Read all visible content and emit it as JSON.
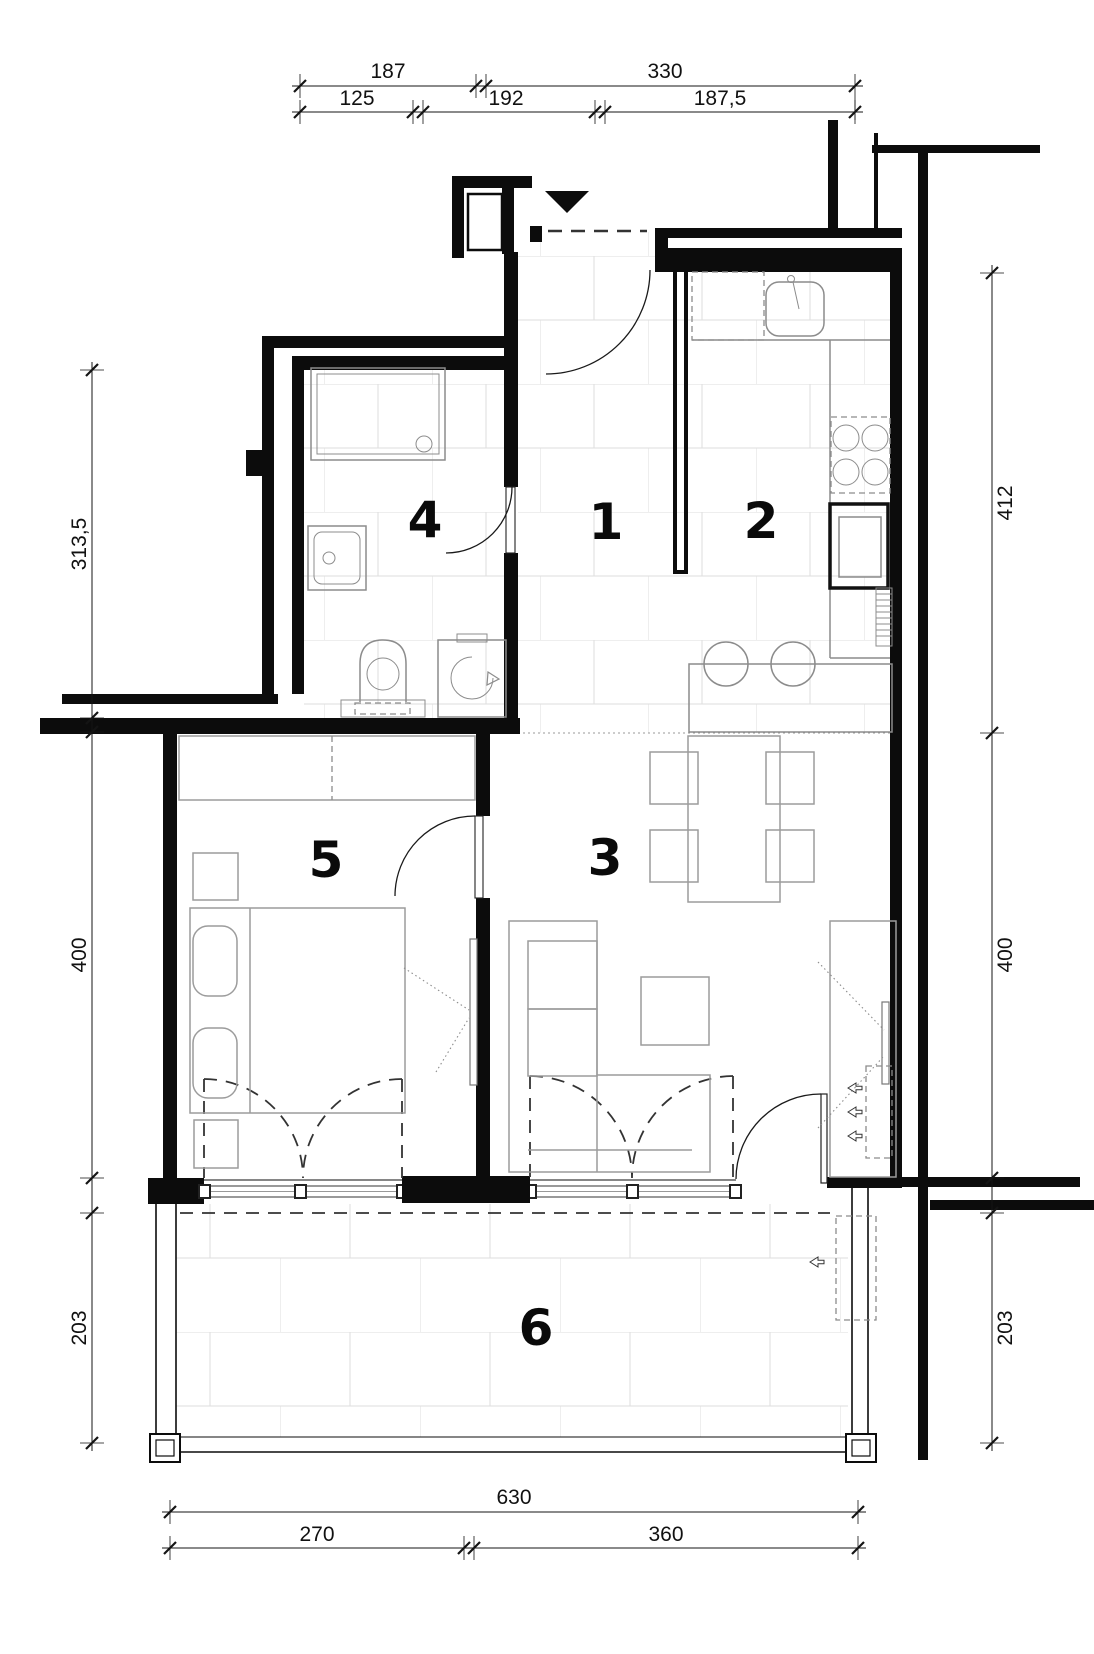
{
  "colors": {
    "wall": "#0c0c0c",
    "fixture": "#8c8c8c",
    "furniture": "#9c9c9c",
    "tile": "#dedede",
    "dash": "#333333",
    "dim": "#141414",
    "floor": "#ffffff"
  },
  "dimensions": {
    "top_row1": [
      "187",
      "330"
    ],
    "top_row2": [
      "125",
      "192",
      "187,5"
    ],
    "left": [
      "313,5",
      "400",
      "203"
    ],
    "right": [
      "412",
      "400",
      "203"
    ],
    "bottom_row1": [
      "630"
    ],
    "bottom_row2": [
      "270",
      "360"
    ]
  },
  "rooms": [
    "1",
    "2",
    "3",
    "4",
    "5",
    "6"
  ]
}
